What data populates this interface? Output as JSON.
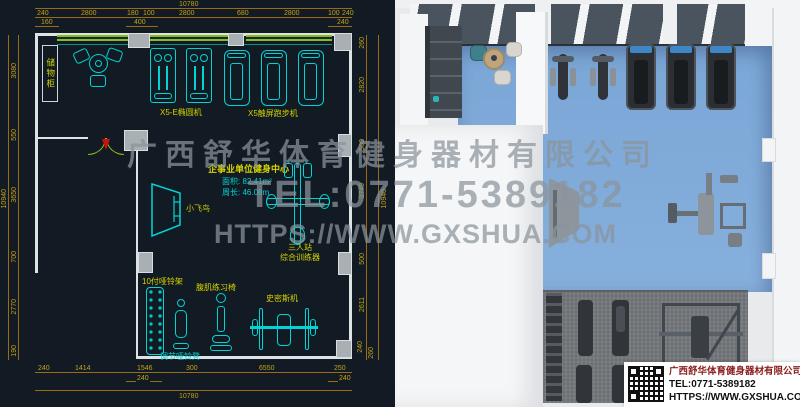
{
  "colors": {
    "cad-bg": "#121a23",
    "cyan": "#00d4d4",
    "yellow": "#d4d400",
    "dim-line": "#9a6a14",
    "dim-text": "#c2a418",
    "wall-green": "#8fba1c",
    "wall-white": "#dde2e5",
    "col-gray": "#a9b0b4",
    "door-red": "#cc1111",
    "floor-blue": "#86afdc",
    "mat-gray": "#75787c",
    "glass": "#4a545e",
    "equip-dark": "#31353a",
    "console-blue": "#3f86c9",
    "card-red": "#8a1d1d",
    "wm": "#8b949c"
  },
  "cad": {
    "info": {
      "title": "企事业单位健身中心",
      "area": "面积: 82.41m²",
      "perimeter": "周长: 46.08m"
    },
    "labels": {
      "storage": "储物柜",
      "elliptical": "X5-E椭圆机",
      "treadmill": "X5触屏跑步机",
      "flybird": "小飞鸟",
      "trainer1": "三人站",
      "trainer2": "综合训练器",
      "rack": "10付哑铃架",
      "abchair": "腹肌练习椅",
      "smith": "史密斯机",
      "bench": "调节哑铃凳"
    },
    "dims": {
      "top_total": "10780",
      "top1": [
        "240",
        "2800",
        "180",
        "100",
        "2800",
        "680",
        "2800",
        "100",
        "240"
      ],
      "top2": [
        "160",
        "400",
        "240"
      ],
      "left1": [
        "3080",
        "550",
        "3650",
        "700",
        "2770",
        "190"
      ],
      "left_total": "10940",
      "right1": [
        "260",
        "2820",
        "500",
        "3749",
        "500",
        "2611",
        "240",
        "260"
      ],
      "right_total": "10940",
      "bottom1": [
        "240",
        "1414",
        "1546",
        "300",
        "6550",
        "250"
      ],
      "bottom2": [
        "240",
        "240"
      ],
      "bottom_total": "10780"
    }
  },
  "watermark": {
    "line1": "广西舒华体育健身器材有限公司",
    "line2": "TEL:0771-5389182",
    "line3": "HTTPS://WWW.GXSHUA.COM"
  },
  "card": {
    "company": "广西舒华体育健身器材有限公司",
    "tel": "TEL:0771-5389182",
    "web": "HTTPS://WWW.GXSHUA.COM"
  }
}
